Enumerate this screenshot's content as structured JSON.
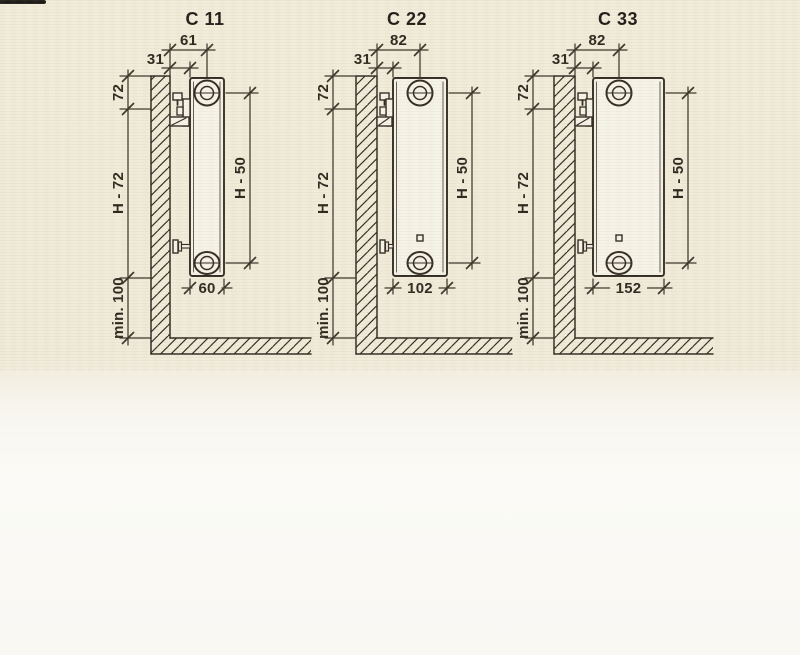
{
  "colors": {
    "paper": "#f1ecdb",
    "paper_lower": "#f9f8f3",
    "ink": "#322b23",
    "dim_ink": "#3c342b",
    "text_ink": "#2b2158",
    "label_ink": "#2e2820",
    "title_ink": "#211d18",
    "radiator_fill": "#f6f3e8",
    "scan_artifact": "#1d1c1a"
  },
  "diagrams": [
    {
      "title": "C 11",
      "labels": {
        "wall_to_hub_depth": "61",
        "wall_clearance": "31",
        "top_to_bracket": "72",
        "bracket_to_bottom": "H - 72",
        "hub_to_hub": "H - 50",
        "radiator_depth": "60",
        "floor_clearance": "min. 100"
      }
    },
    {
      "title": "C 22",
      "labels": {
        "wall_to_hub_depth": "82",
        "wall_clearance": "31",
        "top_to_bracket": "72",
        "bracket_to_bottom": "H - 72",
        "hub_to_hub": "H - 50",
        "radiator_depth": "102",
        "floor_clearance": "min. 100"
      }
    },
    {
      "title": "C 33",
      "labels": {
        "wall_to_hub_depth": "82",
        "wall_clearance": "31",
        "top_to_bracket": "72",
        "bracket_to_bottom": "H - 72",
        "hub_to_hub": "H - 50",
        "radiator_depth": "152",
        "floor_clearance": "min. 100"
      }
    }
  ]
}
